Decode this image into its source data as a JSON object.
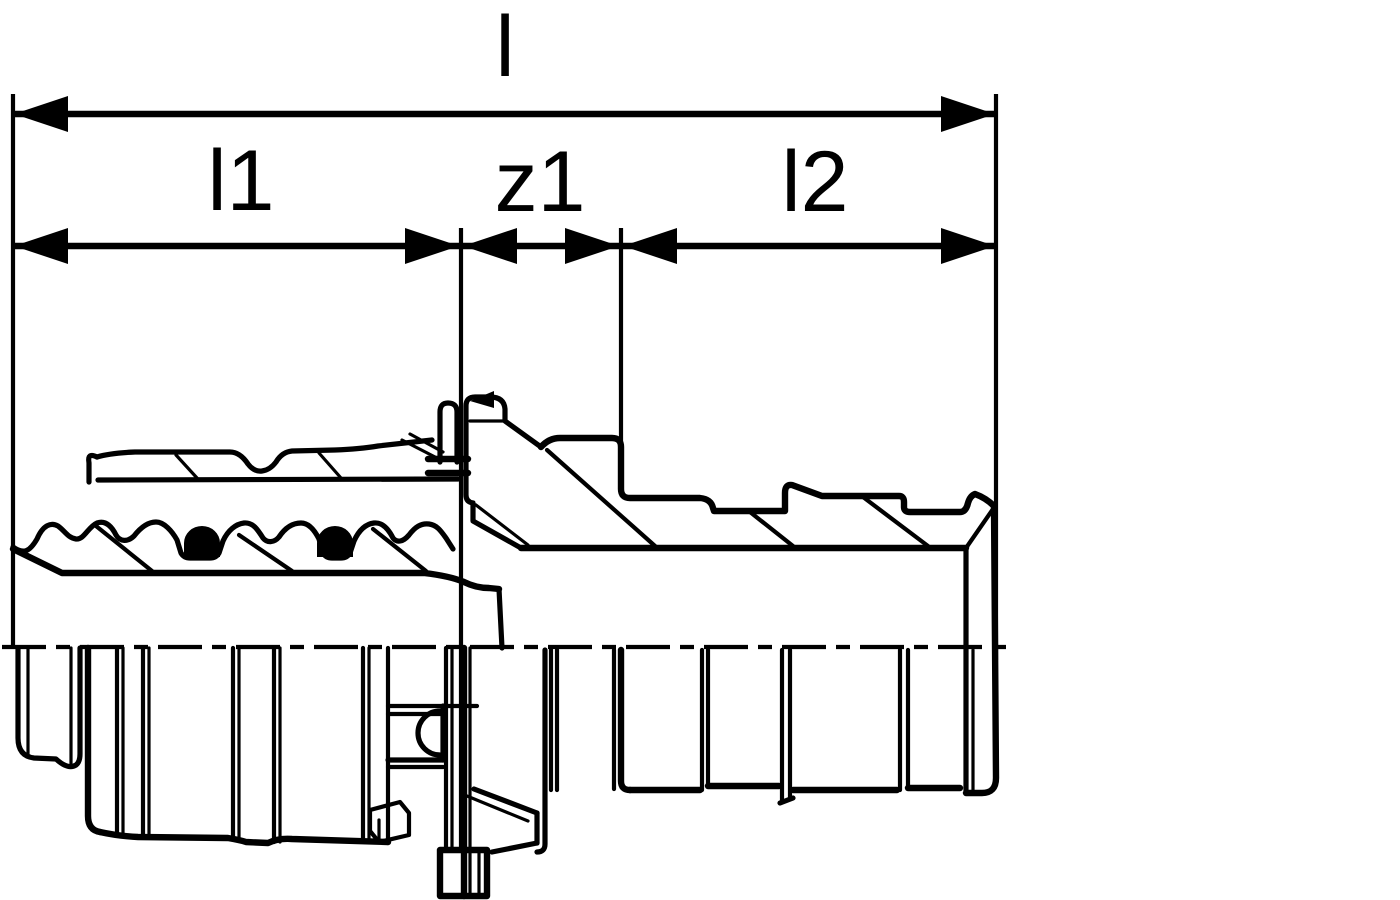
{
  "diagram": {
    "background_color": "#ffffff",
    "line_color": "#000000",
    "centerline_style": "dash-dot",
    "dimension_labels": {
      "overall": "l",
      "left_segment": "l1",
      "middle_segment": "z1",
      "right_segment": "l2"
    }
  }
}
